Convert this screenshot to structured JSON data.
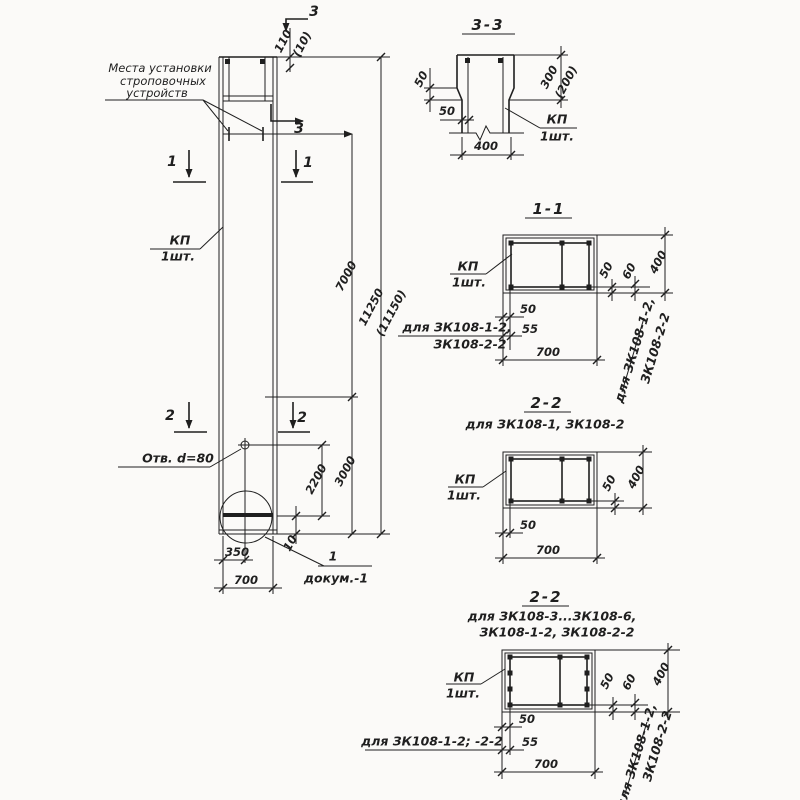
{
  "palette": {
    "paper": "#fbfaf8",
    "ink": "#1f1f1f"
  },
  "elevation": {
    "strop_callout": {
      "l1": "Места установки",
      "l2": "строповочных",
      "l3": "устройств"
    },
    "kp_label": "КП",
    "kp_qty": "1шт.",
    "hole_label": "Отв. d=80",
    "detail_ref": "1",
    "detail_doc": "докум.-1",
    "marks": {
      "s3": "3",
      "s1": "1",
      "s2": "2"
    },
    "dims": {
      "top": "110",
      "top_alt": "(10)",
      "upper": "7000",
      "total": "11250",
      "total_alt": "(11150)",
      "lower": "3000",
      "hole_offset": "2200",
      "plate_gap": "10",
      "half_width": "350",
      "width": "700"
    }
  },
  "section_33": {
    "title": "3-3",
    "kp_label": "КП",
    "kp_qty": "1шт.",
    "dims": {
      "chamfer_v": "50",
      "wall": "50",
      "depth": "300",
      "depth_alt": "(200)",
      "width": "400"
    }
  },
  "section_11": {
    "title": "1-1",
    "kp_label": "КП",
    "kp_qty": "1шт.",
    "dims": {
      "cover_a": "50",
      "cover_b": "55",
      "width": "700",
      "side_a": "50",
      "side_b": "60",
      "height": "400"
    },
    "note_left_l1": "для ЗК108-1-2,",
    "note_left_l2": "ЗК108-2-2",
    "note_right_l1": "для ЗК108-1-2,",
    "note_right_l2": "ЗК108-2-2"
  },
  "section_22a": {
    "title": "2-2",
    "subtitle": "для ЗК108-1, ЗК108-2",
    "kp_label": "КП",
    "kp_qty": "1шт.",
    "dims": {
      "cover": "50",
      "width": "700",
      "side": "50",
      "height": "400"
    }
  },
  "section_22b": {
    "title": "2-2",
    "subtitle_l1": "для ЗК108-3...ЗК108-6,",
    "subtitle_l2": "ЗК108-1-2, ЗК108-2-2",
    "kp_label": "КП",
    "kp_qty": "1шт.",
    "dims": {
      "cover_a": "50",
      "cover_b": "55",
      "width": "700",
      "side_a": "50",
      "side_b": "60",
      "height": "400"
    },
    "note_left": "для ЗК108-1-2; -2-2",
    "note_right_l1": "для ЗК108-1-2,",
    "note_right_l2": "ЗК108-2-2"
  }
}
